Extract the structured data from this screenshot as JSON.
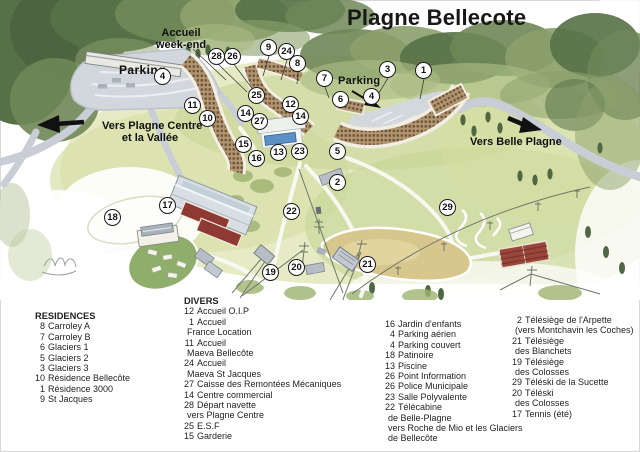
{
  "title": "Plagne Bellecote",
  "map": {
    "labels": {
      "accueil1": "Accueil",
      "accueil2": "week-end",
      "parking_left": "Parking",
      "parking_right": "Parking",
      "vers_plagne1": "Vers Plagne Centre",
      "vers_plagne2": "et la Vallée",
      "vers_belle": "Vers Belle Plagne"
    },
    "markers": [
      "28",
      "26",
      "4",
      "11",
      "10",
      "9",
      "24",
      "8",
      "7",
      "3",
      "1",
      "6",
      "4",
      "25",
      "12",
      "14",
      "14",
      "27",
      "15",
      "13",
      "23",
      "16",
      "5",
      "2",
      "17",
      "18",
      "22",
      "29",
      "21",
      "19",
      "20"
    ]
  },
  "legend": {
    "residences": {
      "heading": "RESIDENCES",
      "items": [
        {
          "num": "8",
          "label": "Carroley A"
        },
        {
          "num": "7",
          "label": "Carroley B"
        },
        {
          "num": "6",
          "label": "Glaciers 1"
        },
        {
          "num": "5",
          "label": "Glaciers 2"
        },
        {
          "num": "3",
          "label": "Glaciers 3"
        },
        {
          "num": "10",
          "label": "Résidence Bellecôte"
        },
        {
          "num": "1",
          "label": "Résidence 3000"
        },
        {
          "num": "9",
          "label": "St Jacques"
        }
      ]
    },
    "divers": {
      "heading": "DIVERS",
      "items": [
        {
          "num": "12",
          "label": "Accueil O.I.P"
        },
        {
          "num": "1",
          "label": "Accueil"
        },
        {
          "num": "",
          "label": "France Location"
        },
        {
          "num": "11",
          "label": "Accueil"
        },
        {
          "num": "",
          "label": "Maeva Bellecôte"
        },
        {
          "num": "24",
          "label": "Accueil"
        },
        {
          "num": "",
          "label": "Maeva St Jacques"
        },
        {
          "num": "27",
          "label": "Caisse des Remontées Mécaniques"
        },
        {
          "num": "14",
          "label": "Centre commercial"
        },
        {
          "num": "28",
          "label": "Départ navette"
        },
        {
          "num": "",
          "label": "vers Plagne Centre"
        },
        {
          "num": "25",
          "label": "E.S.F"
        },
        {
          "num": "15",
          "label": "Garderie"
        }
      ]
    },
    "col3": {
      "items": [
        {
          "num": "16",
          "label": "Jardin d'enfants"
        },
        {
          "num": "4",
          "label": "Parking aérien"
        },
        {
          "num": "4",
          "label": "Parking couvert"
        },
        {
          "num": "18",
          "label": "Patinoire"
        },
        {
          "num": "13",
          "label": "Piscine"
        },
        {
          "num": "26",
          "label": "Point Information"
        },
        {
          "num": "26",
          "label": "Police Municipale"
        },
        {
          "num": "23",
          "label": "Salle Polyvalente"
        },
        {
          "num": "22",
          "label": "Télécabine"
        },
        {
          "num": "",
          "label": "de Belle-Plagne"
        },
        {
          "num": "",
          "label": "vers Roche de Mio et les Glaciers"
        },
        {
          "num": "",
          "label": "de Bellecôte"
        }
      ]
    },
    "col4": {
      "items": [
        {
          "num": "2",
          "label": "Télésiège de l'Arpette"
        },
        {
          "num": "",
          "label": "(vers Montchavin les Coches)"
        },
        {
          "num": "21",
          "label": "Télésiège"
        },
        {
          "num": "",
          "label": "des Blanchets"
        },
        {
          "num": "19",
          "label": "Télésiège"
        },
        {
          "num": "",
          "label": "des Colosses"
        },
        {
          "num": "29",
          "label": "Téléski de la Sucette"
        },
        {
          "num": "20",
          "label": "Téléski"
        },
        {
          "num": "",
          "label": "des Colosses"
        },
        {
          "num": "17",
          "label": "Tennis (été)"
        }
      ]
    }
  }
}
